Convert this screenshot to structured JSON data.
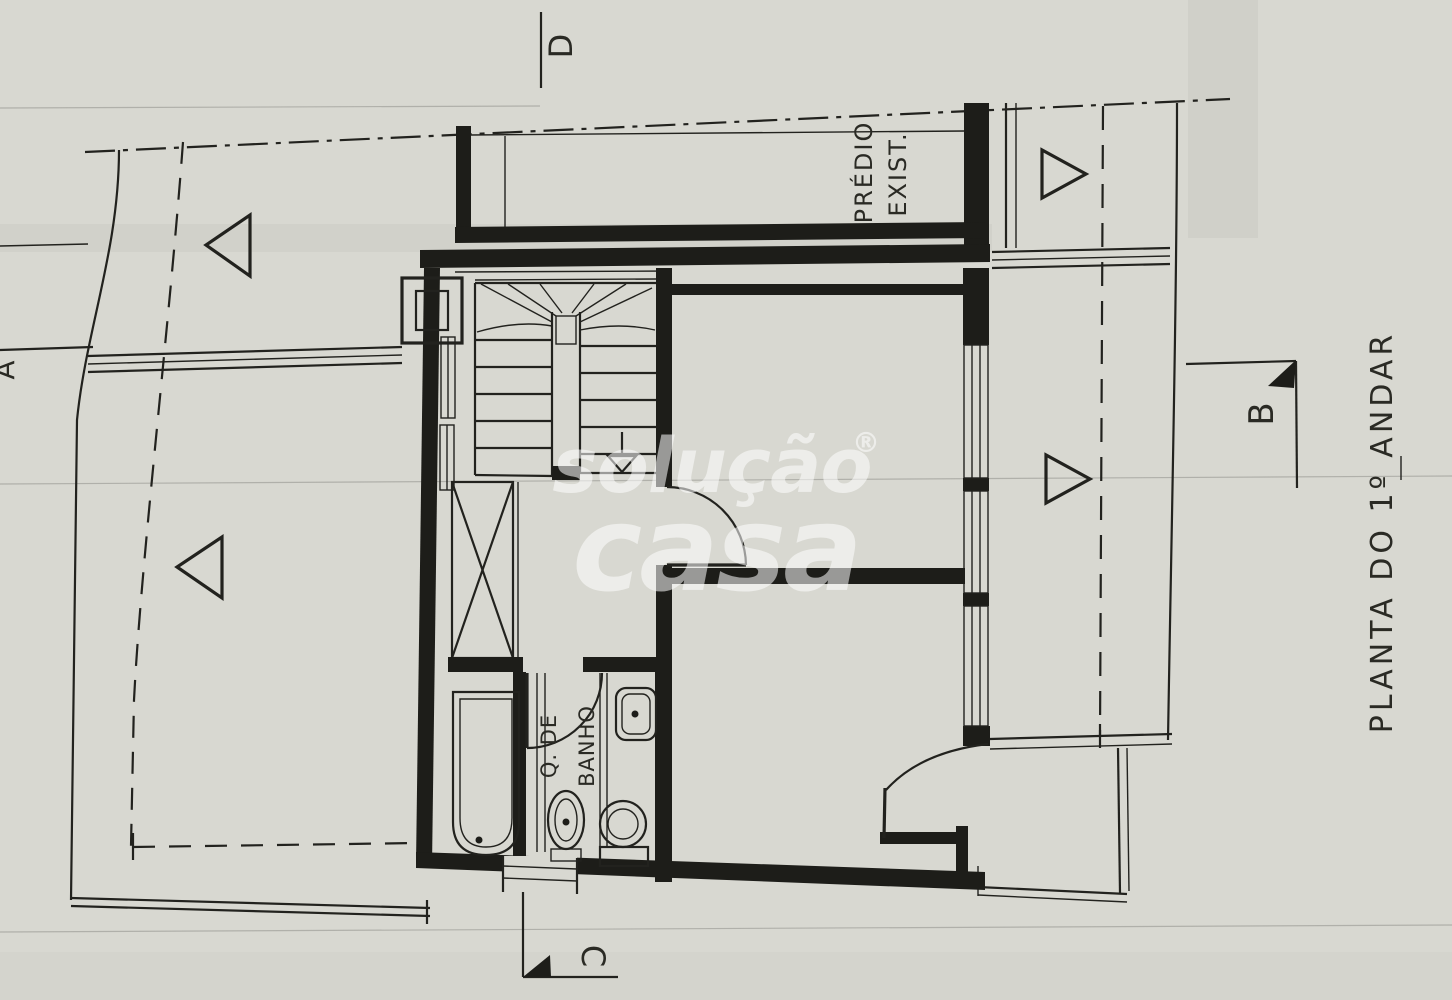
{
  "watermark": {
    "line1": "solução",
    "registered": "®",
    "line2": "casa"
  },
  "title": {
    "text": "PLANTA DO 1º ANDAR"
  },
  "labels": {
    "existing_building_line1": "PRÉDIO",
    "existing_building_line2": "EXIST.",
    "bathroom_line1": "Q. DE",
    "bathroom_line2": "BANHO"
  },
  "section_markers": {
    "a": "A",
    "b": "B",
    "c": "C",
    "d": "D"
  },
  "colors": {
    "paper": "#d8d8d1",
    "ink": "#22221e",
    "shading_band": "#bdbdb6",
    "watermark": "#ffffff"
  }
}
